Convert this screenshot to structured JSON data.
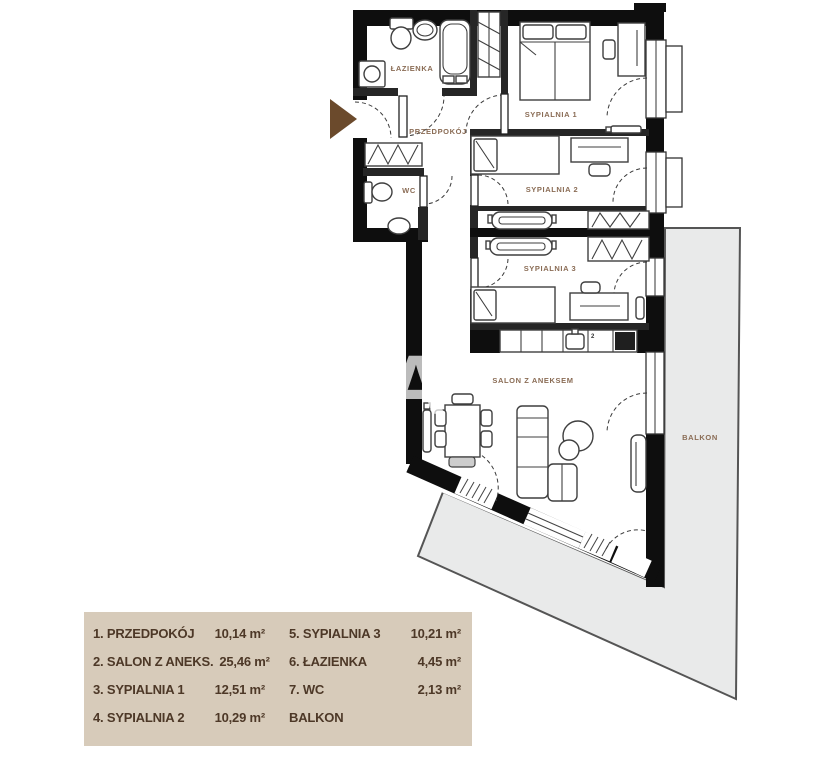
{
  "colors": {
    "wall": "#0e0e0e",
    "thin_wall": "#262626",
    "furniture": "#3f3f3f",
    "balcony_fill": "#e9eaea",
    "balcony_border": "#555555",
    "legend_bg": "#d7cbba",
    "legend_text": "#4d3827",
    "room_label": "#8a6c55",
    "arrow": "#6b4a2c",
    "watermark_color": "#ffffff"
  },
  "plan": {
    "watermark": "SA",
    "stove_mark": "2",
    "rooms": [
      {
        "id": "lazienka",
        "label": "ŁAZIENKA"
      },
      {
        "id": "przedpokoj",
        "label": "PRZEDPOKÓJ"
      },
      {
        "id": "wc",
        "label": "WC"
      },
      {
        "id": "sypialnia1",
        "label": "SYPIALNIA 1"
      },
      {
        "id": "sypialnia2",
        "label": "SYPIALNIA 2"
      },
      {
        "id": "sypialnia3",
        "label": "SYPIALNIA 3"
      },
      {
        "id": "salon",
        "label": "SALON Z ANEKSEM"
      },
      {
        "id": "balkon",
        "label": "BALKON"
      }
    ]
  },
  "legend": {
    "items": [
      {
        "label": "1. PRZEDPOKÓJ",
        "area": "10,14 m²"
      },
      {
        "label": "2. SALON Z ANEKS.",
        "area": "25,46 m²"
      },
      {
        "label": "3. SYPIALNIA 1",
        "area": "12,51 m²"
      },
      {
        "label": "4. SYPIALNIA 2",
        "area": "10,29 m²"
      },
      {
        "label": "5. SYPIALNIA 3",
        "area": "10,21 m²"
      },
      {
        "label": "6. ŁAZIENKA",
        "area": "4,45 m²"
      },
      {
        "label": "7. WC",
        "area": "2,13 m²"
      },
      {
        "label": "BALKON",
        "area": ""
      }
    ]
  }
}
